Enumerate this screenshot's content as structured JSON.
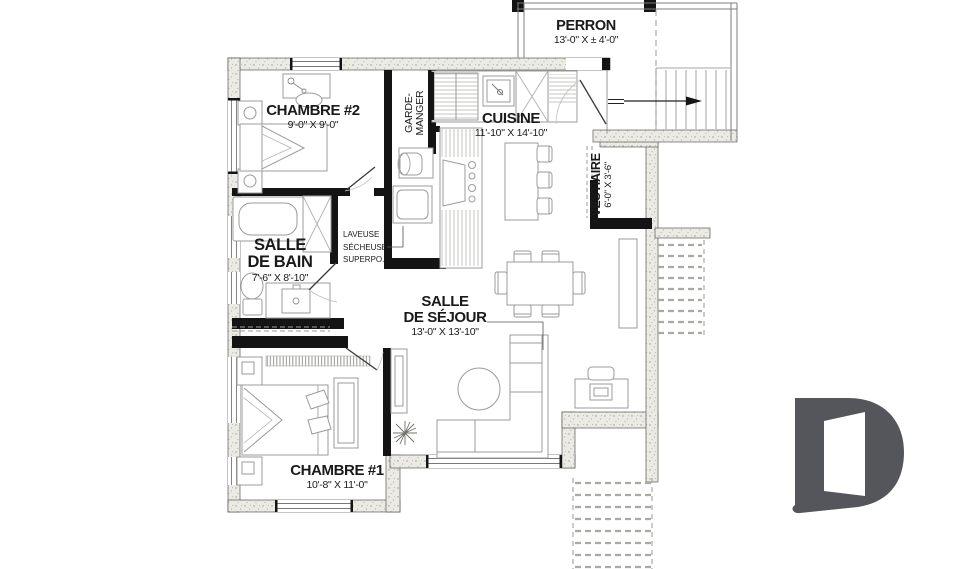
{
  "plan": {
    "perron": {
      "name": "PERRON",
      "dims": "13'-0\" X ± 4'-0\""
    },
    "chambre2": {
      "name": "CHAMBRE #2",
      "dims": "9'-0\" X 9'-0\""
    },
    "garde_manger": {
      "line1": "GARDE-",
      "line2": "MANGER"
    },
    "cuisine": {
      "name": "CUISINE",
      "dims": "11'-10\" X 14'-10\""
    },
    "vestiaire": {
      "name": "VESTIAIRE",
      "dims": "6'-0\" X 3'-6\""
    },
    "salle_de_bain": {
      "line1": "SALLE",
      "line2": "DE BAIN",
      "dims": "7'-6\" X 8'-10\""
    },
    "laveuse": {
      "line1": "LAVEUSE",
      "line2": "SÉCHEUSE",
      "line3": "SUPERPO."
    },
    "salle_de_sejour": {
      "line1": "SALLE",
      "line2": "DE SÉJOUR",
      "dims": "13'-0\" X 13'-10\""
    },
    "chambre1": {
      "name": "CHAMBRE #1",
      "dims": "10'-8\" X 11'-0\""
    }
  },
  "branding": {
    "logo_letter": "D",
    "logo_color": "#54565b"
  }
}
